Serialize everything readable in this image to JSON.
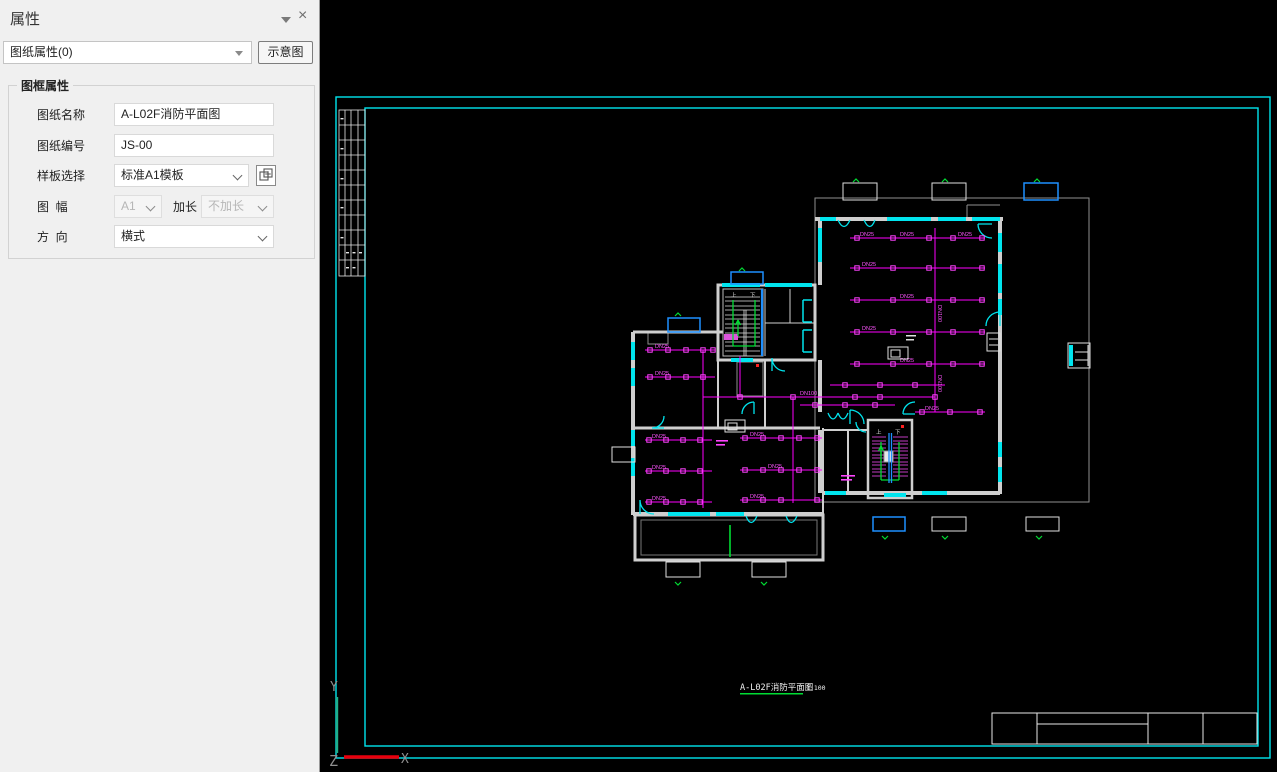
{
  "panel": {
    "title": "属性",
    "selector_value": "图纸属性(0)",
    "schematic_button": "示意图",
    "icons": {
      "close": "×"
    },
    "group": {
      "title": "图框属性",
      "fields": [
        {
          "label": "图纸名称",
          "value": "A-L02F消防平面图",
          "type": "text"
        },
        {
          "label": "图纸编号",
          "value": "JS-00",
          "type": "text"
        },
        {
          "label": "样板选择",
          "value": "标准A1模板",
          "type": "select"
        },
        {
          "label": "图  幅",
          "value": "A1",
          "type": "select",
          "disabled": true,
          "extra_label": "加长",
          "extra_value": "不加长"
        },
        {
          "label": "方  向",
          "value": "横式",
          "type": "select"
        }
      ]
    }
  },
  "canvas": {
    "sheet_title": "A-L02F消防平面图",
    "sheet_scale": "1:100",
    "axis": {
      "x": "X",
      "y": "Y",
      "z": "Z"
    },
    "stair": {
      "up": "上",
      "down": "下"
    },
    "pipe": {
      "branch": "DN25",
      "main": "DN100"
    },
    "colors": {
      "sheet_border": "#00ffff",
      "pipe_magenta": "#ff00ff",
      "wall_gray": "#cfcfcf",
      "accent_blue": "#1e90ff",
      "mark_green": "#00dd33",
      "axis_red": "#e8000d"
    }
  }
}
